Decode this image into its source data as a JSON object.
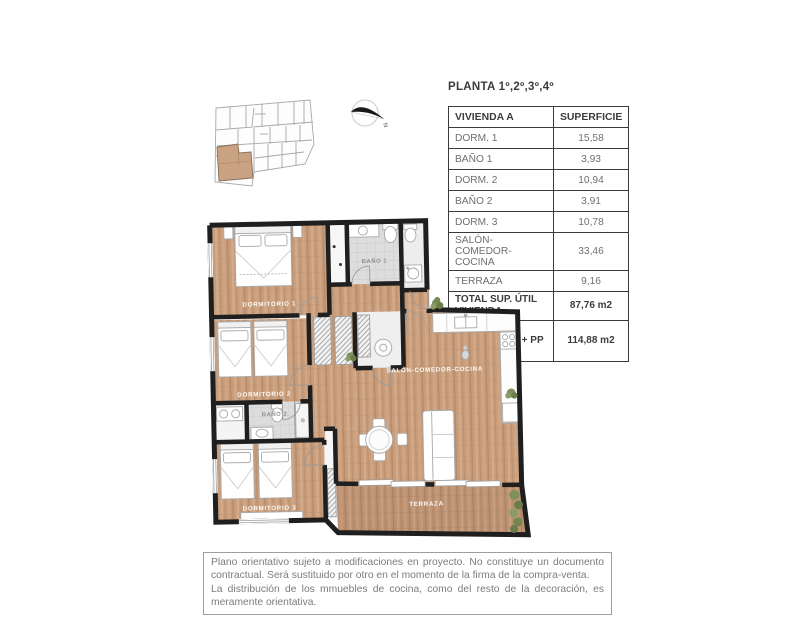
{
  "title": "PLANTA 1º,2º,3º,4º",
  "table": {
    "header": {
      "col1": "VIVIENDA A",
      "col2": "SUPERFICIE"
    },
    "rows": [
      {
        "label": "DORM. 1",
        "value": "15,58"
      },
      {
        "label": "BAÑO 1",
        "value": "3,93"
      },
      {
        "label": "DORM. 2",
        "value": "10,94"
      },
      {
        "label": "BAÑO 2",
        "value": "3,91"
      },
      {
        "label": "DORM. 3",
        "value": "10,78"
      },
      {
        "label": "SALÓN-COMEDOR-COCINA",
        "value": "33,46"
      },
      {
        "label": "TERRAZA",
        "value": "9,16"
      }
    ],
    "totals": [
      {
        "label": "TOTAL SUP. ÚTIL VIVIENDA",
        "value": "87,76 m2"
      },
      {
        "label": "TOTAL SUP. CONSTR. VIV + PP +ZC",
        "value": "114,88 m2"
      }
    ]
  },
  "plan": {
    "rooms": {
      "dorm1": "DORMITORIO 1",
      "bano1": "BAÑO 1",
      "dorm2": "DORMITORIO 2",
      "bano2": "BAÑO 2",
      "dorm3": "DORMITORIO 3",
      "salon": "SALÓN-COMEDOR-COCINA",
      "terraza": "TERRAZA"
    },
    "compass_label": "N"
  },
  "disclaimer": {
    "para1": "Plano orientativo sujeto a modificaciones en proyecto. No constituye un documento contractual. Será sustituido por otro en el momento de la firma de la compra-venta.",
    "para2": "La distribución de los mmuebles de cocina, como del resto de la decoración, es meramente orientativa."
  },
  "colors": {
    "highlight_tan": "#c9a183",
    "wall_black": "#1f1f1f",
    "wood_floor": "#c79d7c",
    "tile_gray": "#dddddd"
  }
}
